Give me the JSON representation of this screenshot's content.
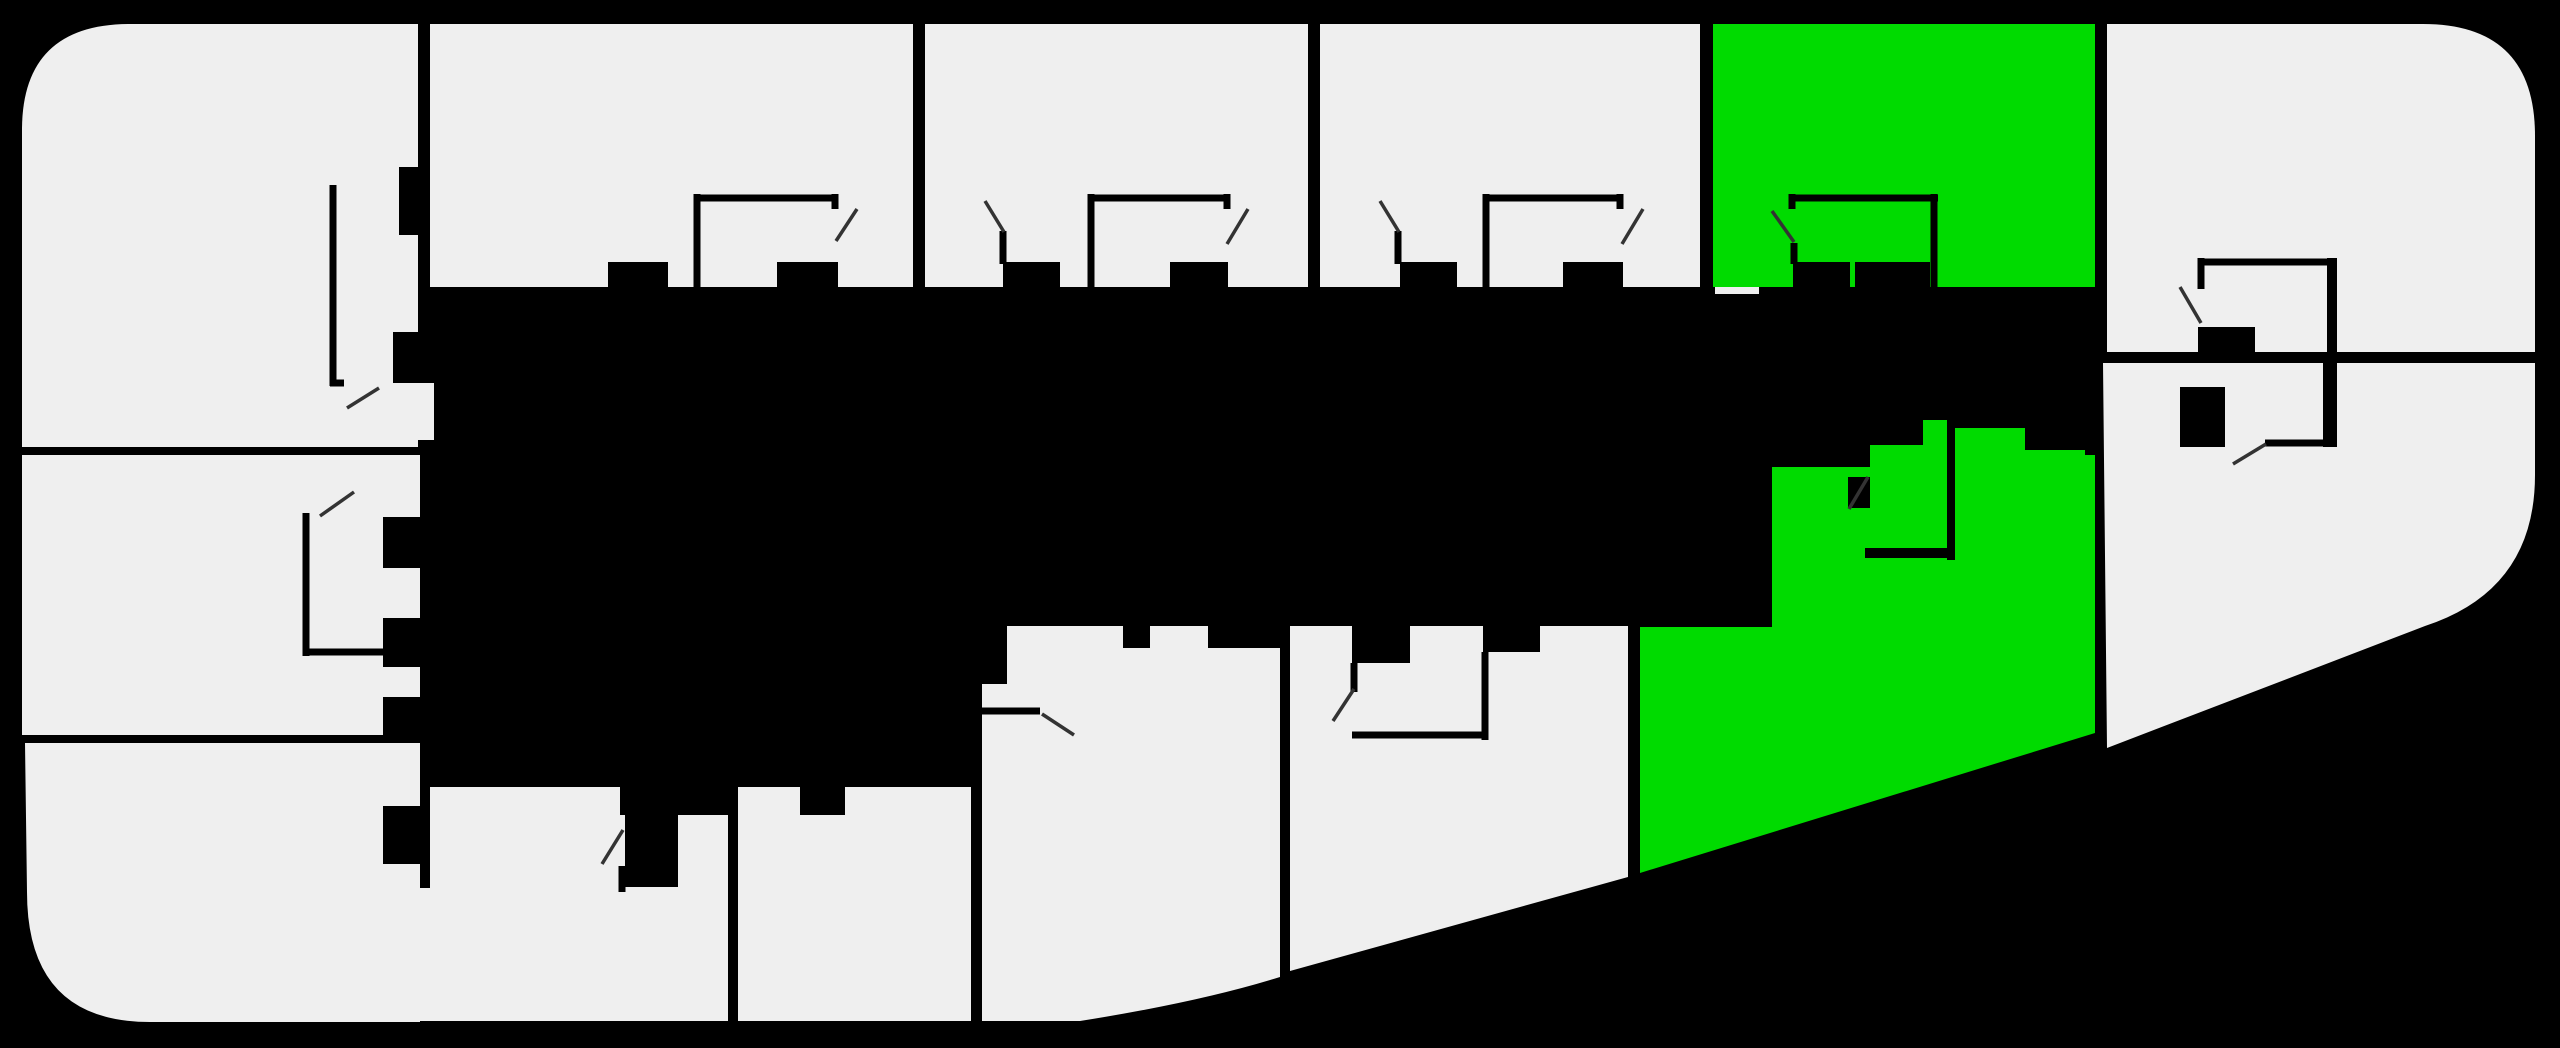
{
  "meta": {
    "title": "building-floor-plan",
    "canvas": {
      "width": 2560,
      "height": 1048
    },
    "unit_count": 14,
    "highlighted_count": 2,
    "highlighted_unit_ids": [
      "unit-top-green",
      "unit-middle-green"
    ]
  },
  "colors": {
    "background": "#000000",
    "unit_default": "#efefef",
    "unit_highlight": "#00db00",
    "wall": "#000000",
    "door_swing": "#333333"
  },
  "units": [
    {
      "id": "unit-top-left",
      "status": "default",
      "d": "M22,130 Q22,24 130,24 L418,24 L418,447 L22,447 Z"
    },
    {
      "id": "unit-top-2",
      "status": "default",
      "d": "M430,24 L913,24 L913,287 L430,287 Z"
    },
    {
      "id": "unit-top-3",
      "status": "default",
      "d": "M925,24 L1308,24 L1308,287 L925,287 Z"
    },
    {
      "id": "unit-top-4",
      "status": "default",
      "d": "M1320,24 L1700,24 L1700,287 L1320,287 Z"
    },
    {
      "id": "unit-top-green",
      "status": "highlighted",
      "d": "M1713,24 L2095,24 L2095,287 L1713,287 Z"
    },
    {
      "id": "unit-top-right",
      "status": "default",
      "d": "M2107,24 L2423,24 Q2535,24 2535,136 L2535,352 L2107,352 Z"
    },
    {
      "id": "unit-left-middle",
      "status": "default",
      "d": "M22,455 L420,455 L420,735 L22,735 Z"
    },
    {
      "id": "unit-left-bottom",
      "status": "default",
      "d": "M25,743 L420,743 L420,1022 L150,1022 Q27,1022 27,892 Z"
    },
    {
      "id": "unit-bottom-1",
      "status": "default",
      "d": "M430,787 L620,787 L620,815 L728,815 L728,1021 L430,1021 Z"
    },
    {
      "id": "unit-bottom-2",
      "status": "default",
      "d": "M738,787 L971,787 L971,1021 L738,1021 Z"
    },
    {
      "id": "unit-middle-1",
      "status": "default",
      "d": "M982,626 L1280,626 L1280,977 Q1200,1002 1080,1021 L982,1021 Z"
    },
    {
      "id": "unit-middle-2",
      "status": "default",
      "d": "M1290,626 L1628,626 L1628,877 L1290,971 Z"
    },
    {
      "id": "unit-middle-green",
      "status": "highlighted",
      "d": "M1640,627 L1772,627 L1772,467 L1870,467 L1870,445 L1923,445 L1923,420 L1955,420 L1955,428 L2025,428 L2025,450 L2085,450 L2085,455 L2095,455 L2095,733 L1640,873 Z"
    },
    {
      "id": "unit-right-bottom",
      "status": "default",
      "d": "M2103,363 L2535,363 L2535,475 Q2535,590 2425,626 L2107,748 Z"
    }
  ],
  "openings": [
    {
      "id": "opening-topleft-corridor",
      "x": 416,
      "y": 383,
      "w": 18,
      "h": 57
    },
    {
      "id": "opening-leftbottom-door",
      "x": 416,
      "y": 888,
      "w": 18,
      "h": 133
    },
    {
      "id": "opening-green-top-sill",
      "x": 1715,
      "y": 287,
      "w": 44,
      "h": 7
    }
  ],
  "piers": [
    {
      "id": "pier-r1-niche",
      "x": 399,
      "y": 167,
      "w": 19,
      "h": 68
    },
    {
      "id": "pier-r1-side",
      "x": 393,
      "y": 332,
      "w": 27,
      "h": 51
    },
    {
      "id": "pier-r2-a",
      "x": 608,
      "y": 262,
      "w": 60,
      "h": 25
    },
    {
      "id": "pier-r2-b",
      "x": 777,
      "y": 262,
      "w": 61,
      "h": 25
    },
    {
      "id": "pier-r3-a",
      "x": 1003,
      "y": 262,
      "w": 57,
      "h": 25
    },
    {
      "id": "pier-r3-b",
      "x": 1170,
      "y": 262,
      "w": 58,
      "h": 25
    },
    {
      "id": "pier-r4-a",
      "x": 1400,
      "y": 262,
      "w": 57,
      "h": 25
    },
    {
      "id": "pier-r4-b",
      "x": 1563,
      "y": 262,
      "w": 60,
      "h": 25
    },
    {
      "id": "pier-g1-a",
      "x": 1793,
      "y": 262,
      "w": 57,
      "h": 25
    },
    {
      "id": "pier-g1-b",
      "x": 1855,
      "y": 262,
      "w": 75,
      "h": 25
    },
    {
      "id": "pier-ml-a",
      "x": 383,
      "y": 517,
      "w": 37,
      "h": 51
    },
    {
      "id": "pier-ml-b",
      "x": 383,
      "y": 618,
      "w": 37,
      "h": 49
    },
    {
      "id": "pier-ml-c",
      "x": 383,
      "y": 697,
      "w": 37,
      "h": 38
    },
    {
      "id": "pier-bl",
      "x": 383,
      "y": 806,
      "w": 37,
      "h": 58
    },
    {
      "id": "pier-bm1",
      "x": 625,
      "y": 815,
      "w": 53,
      "h": 72
    },
    {
      "id": "pier-bm2",
      "x": 800,
      "y": 787,
      "w": 45,
      "h": 28
    },
    {
      "id": "pier-m1-notch",
      "x": 982,
      "y": 626,
      "w": 25,
      "h": 58
    },
    {
      "id": "pier-m1-a",
      "x": 1123,
      "y": 626,
      "w": 27,
      "h": 22
    },
    {
      "id": "pier-m1-b",
      "x": 1208,
      "y": 626,
      "w": 72,
      "h": 22
    },
    {
      "id": "pier-m1-westwall",
      "x": 971,
      "y": 766,
      "w": 9,
      "h": 90
    },
    {
      "id": "pier-m2-a",
      "x": 1352,
      "y": 626,
      "w": 58,
      "h": 37
    },
    {
      "id": "pier-m2-b",
      "x": 1483,
      "y": 626,
      "w": 57,
      "h": 26
    },
    {
      "id": "pier-rtr-closet",
      "x": 2198,
      "y": 327,
      "w": 57,
      "h": 26
    },
    {
      "id": "pier-rtr-wall",
      "x": 2327,
      "y": 258,
      "w": 10,
      "h": 94
    },
    {
      "id": "pier-rr",
      "x": 2180,
      "y": 387,
      "w": 45,
      "h": 60
    },
    {
      "id": "pier-rr-wall",
      "x": 2323,
      "y": 363,
      "w": 14,
      "h": 84
    },
    {
      "id": "pier-g2-bathwall",
      "x": 1947,
      "y": 420,
      "w": 8,
      "h": 140
    },
    {
      "id": "pier-g2-bathbot",
      "x": 1865,
      "y": 548,
      "w": 90,
      "h": 10
    },
    {
      "id": "pier-g2-doorjamb",
      "x": 1848,
      "y": 477,
      "w": 22,
      "h": 31
    }
  ],
  "wall_lines": [
    {
      "id": "wall-r2-closet-left",
      "x1": 697,
      "y1": 194,
      "x2": 697,
      "y2": 287
    },
    {
      "id": "wall-r2-closet-top",
      "x1": 694,
      "y1": 198,
      "x2": 838,
      "y2": 198
    },
    {
      "id": "wall-r2-closet-stub",
      "x1": 835,
      "y1": 194,
      "x2": 835,
      "y2": 209
    },
    {
      "id": "wall-r3-closet-left",
      "x1": 1091,
      "y1": 194,
      "x2": 1091,
      "y2": 287
    },
    {
      "id": "wall-r3-closet-top",
      "x1": 1088,
      "y1": 198,
      "x2": 1230,
      "y2": 198
    },
    {
      "id": "wall-r3-closet-stub",
      "x1": 1227,
      "y1": 194,
      "x2": 1227,
      "y2": 209
    },
    {
      "id": "wall-r3-entry-stub",
      "x1": 1003,
      "y1": 231,
      "x2": 1003,
      "y2": 264
    },
    {
      "id": "wall-r4-closet-left",
      "x1": 1486,
      "y1": 194,
      "x2": 1486,
      "y2": 287
    },
    {
      "id": "wall-r4-closet-top",
      "x1": 1483,
      "y1": 198,
      "x2": 1623,
      "y2": 198
    },
    {
      "id": "wall-r4-closet-stub",
      "x1": 1620,
      "y1": 194,
      "x2": 1620,
      "y2": 209
    },
    {
      "id": "wall-r4-entry-stub",
      "x1": 1398,
      "y1": 231,
      "x2": 1398,
      "y2": 264
    },
    {
      "id": "wall-g1-closet-right",
      "x1": 1934,
      "y1": 194,
      "x2": 1934,
      "y2": 287
    },
    {
      "id": "wall-g1-closet-top",
      "x1": 1790,
      "y1": 198,
      "x2": 1938,
      "y2": 198
    },
    {
      "id": "wall-g1-closet-stub",
      "x1": 1792,
      "y1": 194,
      "x2": 1792,
      "y2": 209
    },
    {
      "id": "wall-g1-entry-stub",
      "x1": 1794,
      "y1": 243,
      "x2": 1794,
      "y2": 264
    },
    {
      "id": "wall-r1-niche-vert",
      "x1": 333,
      "y1": 185,
      "x2": 333,
      "y2": 386
    },
    {
      "id": "wall-r1-niche-horiz",
      "x1": 330,
      "y1": 383,
      "x2": 344,
      "y2": 383
    },
    {
      "id": "wall-ml-niche-vert",
      "x1": 306,
      "y1": 513,
      "x2": 306,
      "y2": 656
    },
    {
      "id": "wall-ml-niche-horiz",
      "x1": 303,
      "y1": 652,
      "x2": 383,
      "y2": 652
    },
    {
      "id": "wall-rtr-closet-left",
      "x1": 2201,
      "y1": 258,
      "x2": 2201,
      "y2": 289
    },
    {
      "id": "wall-rtr-closet-top",
      "x1": 2198,
      "y1": 262,
      "x2": 2327,
      "y2": 262
    },
    {
      "id": "wall-m1-entry",
      "x1": 982,
      "y1": 711,
      "x2": 1040,
      "y2": 711
    },
    {
      "id": "wall-m2-closet-right",
      "x1": 1485,
      "y1": 652,
      "x2": 1485,
      "y2": 740
    },
    {
      "id": "wall-m2-closet-bot",
      "x1": 1352,
      "y1": 735,
      "x2": 1488,
      "y2": 735
    },
    {
      "id": "wall-m2-entry-stub",
      "x1": 1354,
      "y1": 663,
      "x2": 1354,
      "y2": 692
    },
    {
      "id": "wall-bm1-stub",
      "x1": 622,
      "y1": 866,
      "x2": 622,
      "y2": 892
    },
    {
      "id": "wall-rr-lintel",
      "x1": 2265,
      "y1": 443,
      "x2": 2323,
      "y2": 443
    }
  ],
  "door_swings": [
    {
      "id": "door-r1",
      "x1": 347,
      "y1": 408,
      "x2": 379,
      "y2": 388
    },
    {
      "id": "door-r2",
      "x1": 836,
      "y1": 241,
      "x2": 857,
      "y2": 209
    },
    {
      "id": "door-r3-entry",
      "x1": 985,
      "y1": 201,
      "x2": 1004,
      "y2": 232
    },
    {
      "id": "door-r3-closet",
      "x1": 1227,
      "y1": 244,
      "x2": 1248,
      "y2": 209
    },
    {
      "id": "door-r4-entry",
      "x1": 1380,
      "y1": 201,
      "x2": 1399,
      "y2": 232
    },
    {
      "id": "door-r4-closet",
      "x1": 1622,
      "y1": 244,
      "x2": 1643,
      "y2": 209
    },
    {
      "id": "door-g1-entry",
      "x1": 1772,
      "y1": 211,
      "x2": 1794,
      "y2": 242
    },
    {
      "id": "door-ml",
      "x1": 320,
      "y1": 516,
      "x2": 354,
      "y2": 492
    },
    {
      "id": "door-bm1",
      "x1": 602,
      "y1": 864,
      "x2": 623,
      "y2": 830
    },
    {
      "id": "door-m1",
      "x1": 1042,
      "y1": 714,
      "x2": 1074,
      "y2": 735
    },
    {
      "id": "door-m2",
      "x1": 1333,
      "y1": 721,
      "x2": 1354,
      "y2": 689
    },
    {
      "id": "door-g2",
      "x1": 1849,
      "y1": 509,
      "x2": 1868,
      "y2": 477
    },
    {
      "id": "door-rtr",
      "x1": 2180,
      "y1": 287,
      "x2": 2201,
      "y2": 323
    },
    {
      "id": "door-rr",
      "x1": 2233,
      "y1": 464,
      "x2": 2266,
      "y2": 444
    }
  ]
}
